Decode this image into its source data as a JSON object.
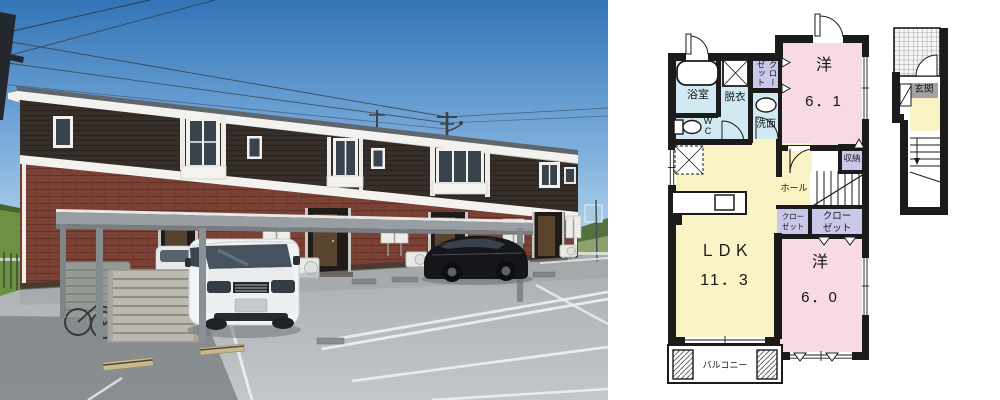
{
  "floorplan": {
    "labels": {
      "bathroom": "浴室",
      "dressing": "脱衣",
      "closet_upper": "クローゼット",
      "washstand": "洗面",
      "wc": "W\nC",
      "room1_name": "洋",
      "room1_size": "6．1",
      "storage": "収納",
      "hall": "ホール",
      "closet_small": "クロー\nゼット",
      "closet_large": "クロー\nゼット",
      "ldk_name": "ＬＤＫ",
      "ldk_size": "11．3",
      "room2_name": "洋",
      "room2_size": "6．0",
      "balcony": "バルコニー",
      "entrance": "玄関"
    },
    "colors": {
      "wall": "#1b1b1b",
      "room_pink": "#f8dae3",
      "room_yellow": "#faf3c6",
      "room_blue": "#d0e9f2",
      "room_lavender": "#cac8ea",
      "entrance_gray": "#a3a3a3"
    }
  },
  "photo": {
    "colors": {
      "sky_top": "#3374b7",
      "sky_horizon": "#cbe2f4",
      "siding_dark": "#362e29",
      "brick": "#7a4134",
      "trim_white": "#f3f2ee",
      "asphalt": "#b6babc"
    }
  }
}
